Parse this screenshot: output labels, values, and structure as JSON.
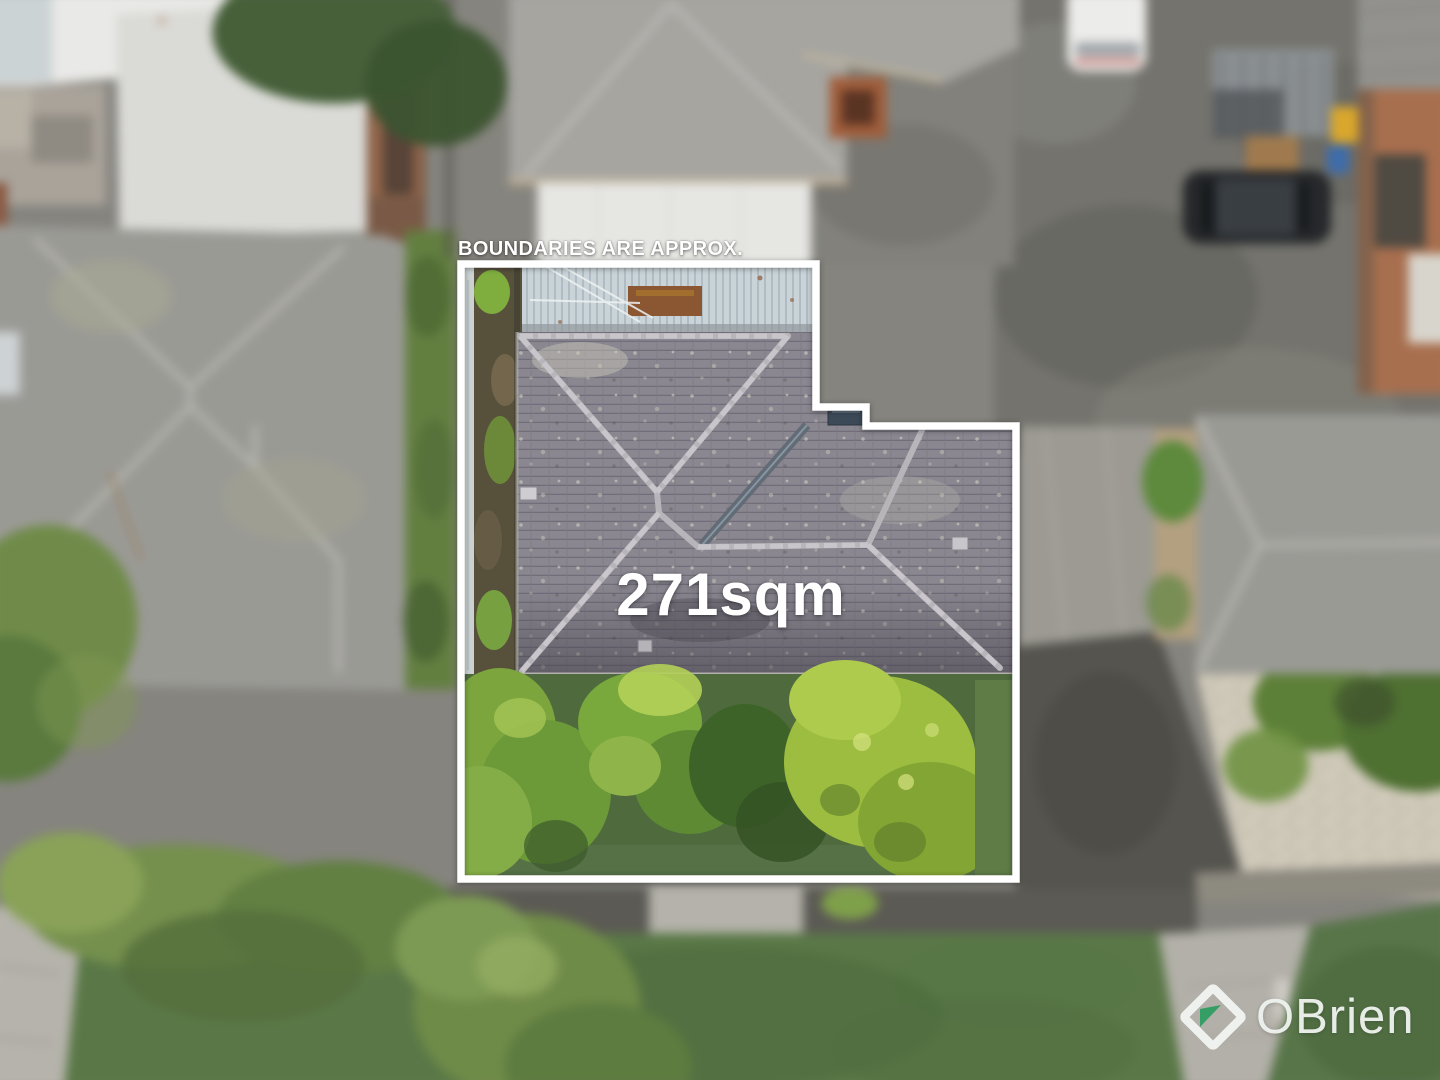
{
  "overlay": {
    "disclaimer_text": "BOUNDARIES ARE APPROX.",
    "area_text": "271sqm",
    "text_color": "#ffffff",
    "boundary_color": "#ffffff",
    "boundary_points": "461,264 816,264 816,407 866,407 866,426 1016,426 1016,879 461,879"
  },
  "logo": {
    "brand_text": "OBrien",
    "text_color": "#eef2ee",
    "diamond_color": "#f1f4f1",
    "triangle_color": "#2f9e63"
  }
}
